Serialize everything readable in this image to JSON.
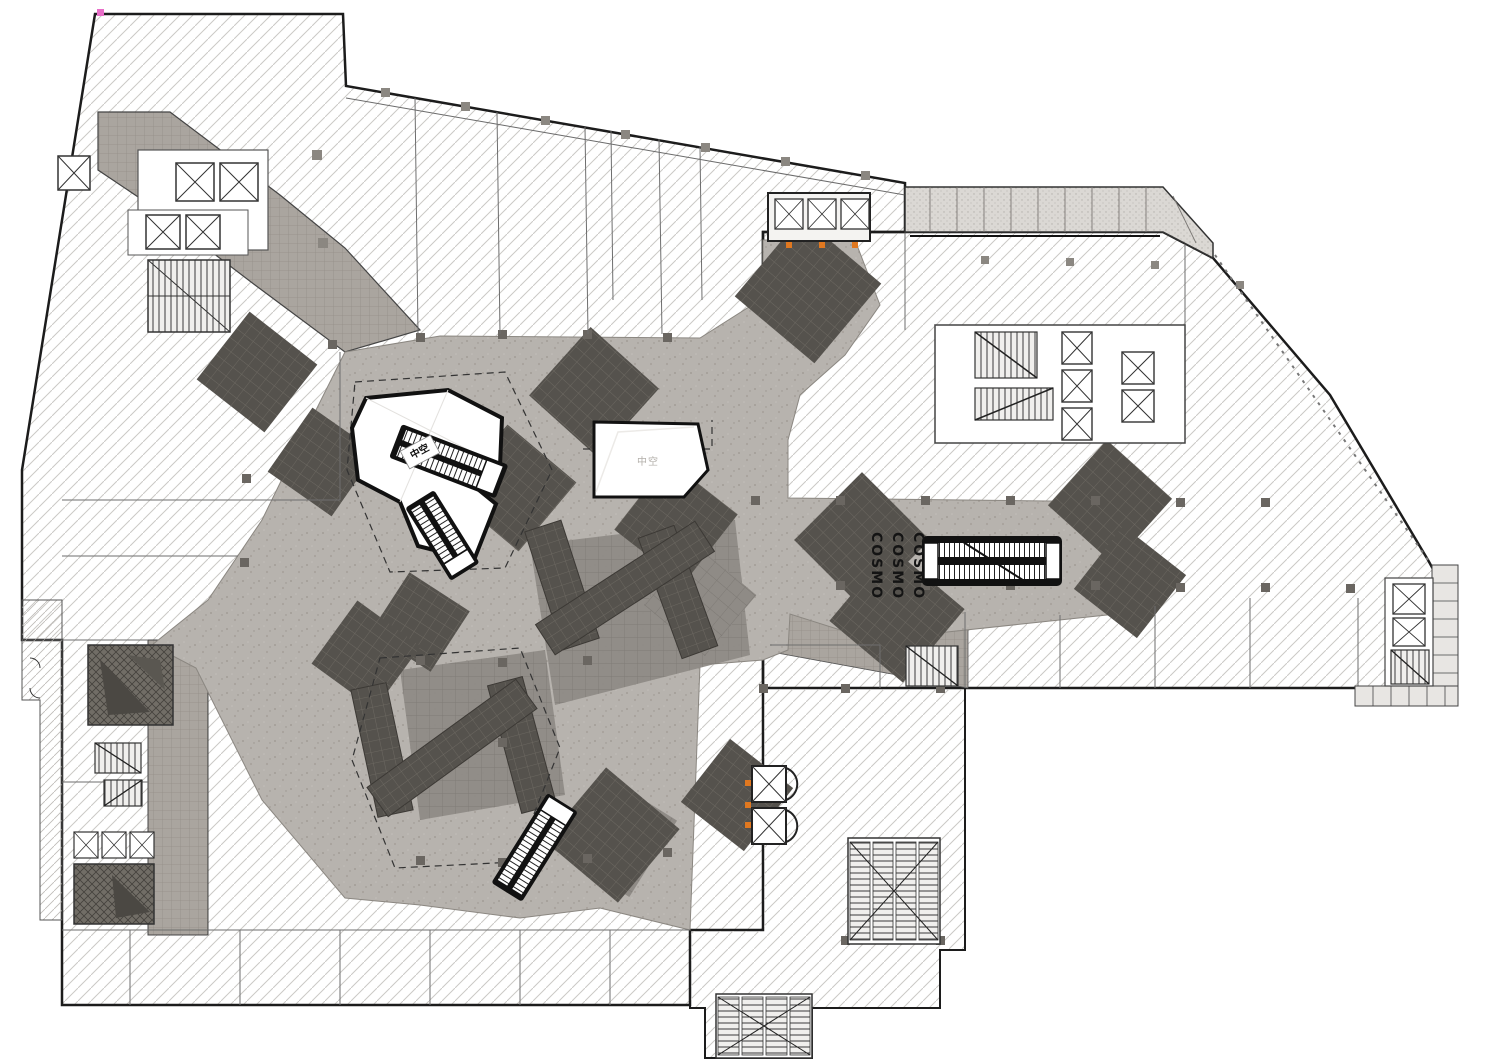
{
  "drawing": {
    "kind": "architectural-floor-plan",
    "level_style": "shopping-mall-concourse"
  },
  "labels": {
    "void_tag": "中空",
    "void_faint": "中空",
    "brand": "COSMO"
  },
  "palette": {
    "background": "#ffffff",
    "hatch_line": "#c9c7c4",
    "plaza_floor": "#b7b3ae",
    "paver_tile": "#aaa59f",
    "zone_medium": "#8f8b86",
    "zone_dark": "#55524d",
    "ink": "#1c1c1c",
    "accent_orange": "#e07820",
    "accent_pink": "#e86ec8"
  },
  "features": {
    "atrium_voids": 2,
    "escalator_pairs": 4,
    "passenger_elevators": 16,
    "panoramic_elevators": 2,
    "stair_runs": 10,
    "brand_text_repeats": 3
  }
}
